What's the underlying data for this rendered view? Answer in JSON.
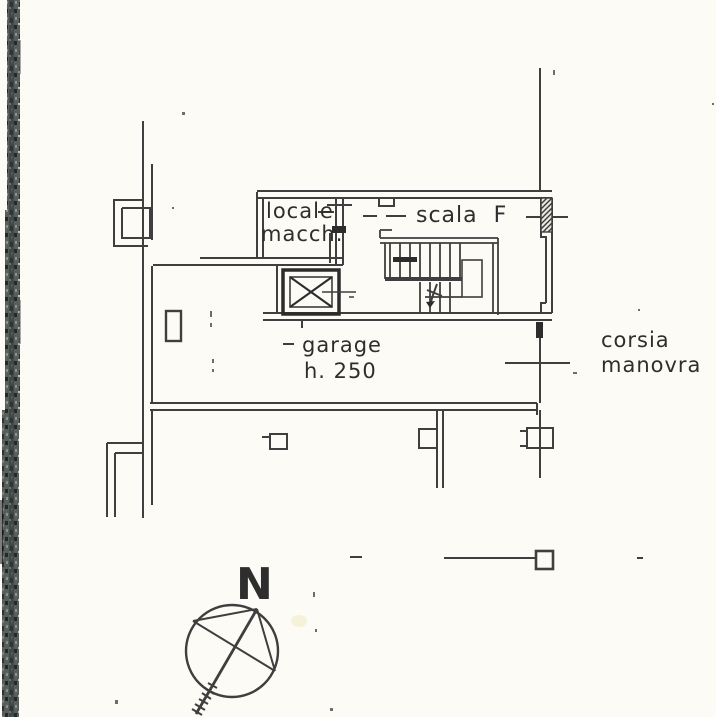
{
  "plan": {
    "labels": {
      "machine_room": {
        "line1": "locale",
        "line2": "macch."
      },
      "staircase": "scala  F",
      "garage": {
        "line1": "garage",
        "line2": "h. 250"
      },
      "driveway": {
        "line1": "corsia",
        "line2": "manovra"
      },
      "compass_north": "N"
    },
    "colors": {
      "ink": "#3f3f3f",
      "ink_dark": "#2c2c2c",
      "paper": "#fcfbf6",
      "scan_band": "#585e5c"
    }
  }
}
